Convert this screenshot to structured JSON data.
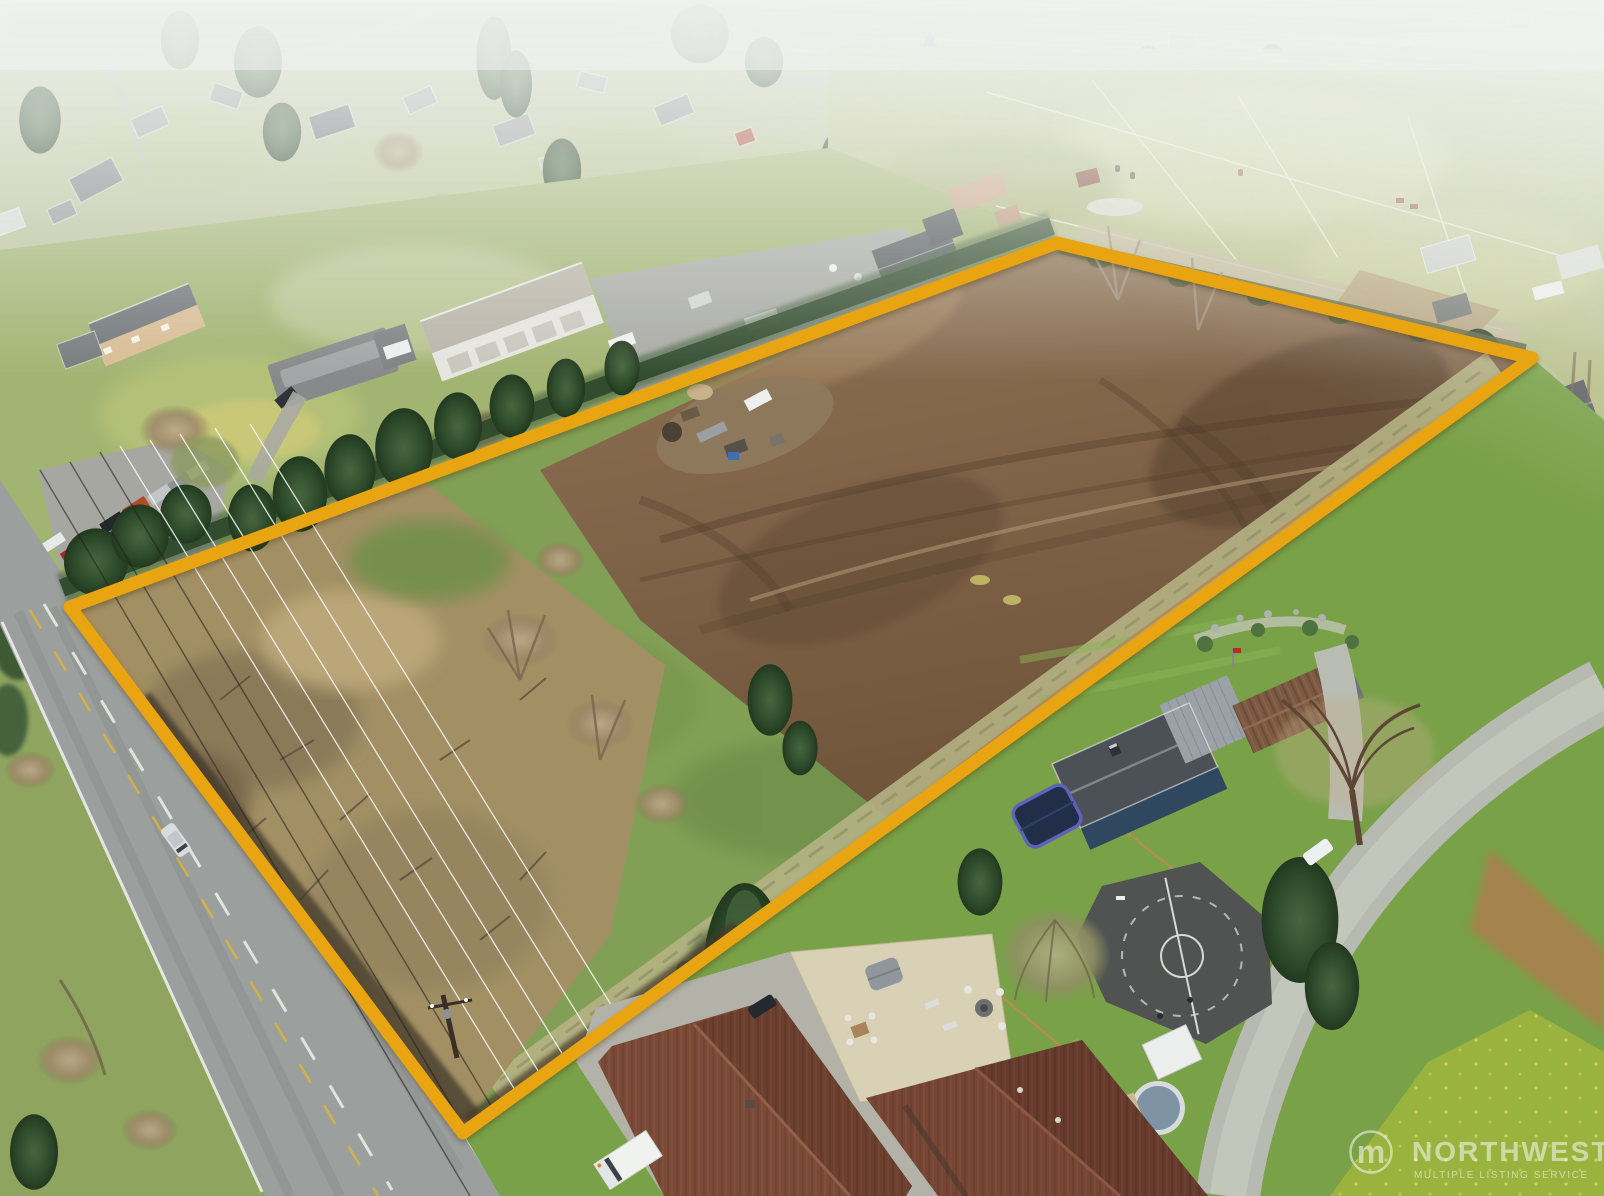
{
  "meta": {
    "type": "aerial-drone-photograph",
    "subject": "vacant acreage parcel outlined in gold in a semi-rural neighborhood",
    "width_px": 1604,
    "height_px": 1196
  },
  "watermark": {
    "brand": "NORTHWEST",
    "tagline": "MULTIPLE LISTING SERVICE",
    "logo_glyph": "m",
    "color": "#ffffff"
  },
  "outline": {
    "points": "70,607 1057,243 1532,358 463,1133",
    "color": "#E8A511",
    "width": "13"
  },
  "palette": {
    "haze": "#f3f5f2",
    "dirt_field": "#84674b",
    "grass_field": "#82a055",
    "brush_scrub": "#a29064",
    "road_asphalt": "#9b9f9e",
    "gravel": "#b6bab0",
    "conifer_green": "#2e4c2b",
    "lawn_bright": "#79a148",
    "court_asphalt": "#505351",
    "roof_brown": "#7b4a37",
    "roof_charcoal": "#4b5156",
    "house_blue_wall": "#30485f",
    "outline_gold": "#E8A511"
  }
}
